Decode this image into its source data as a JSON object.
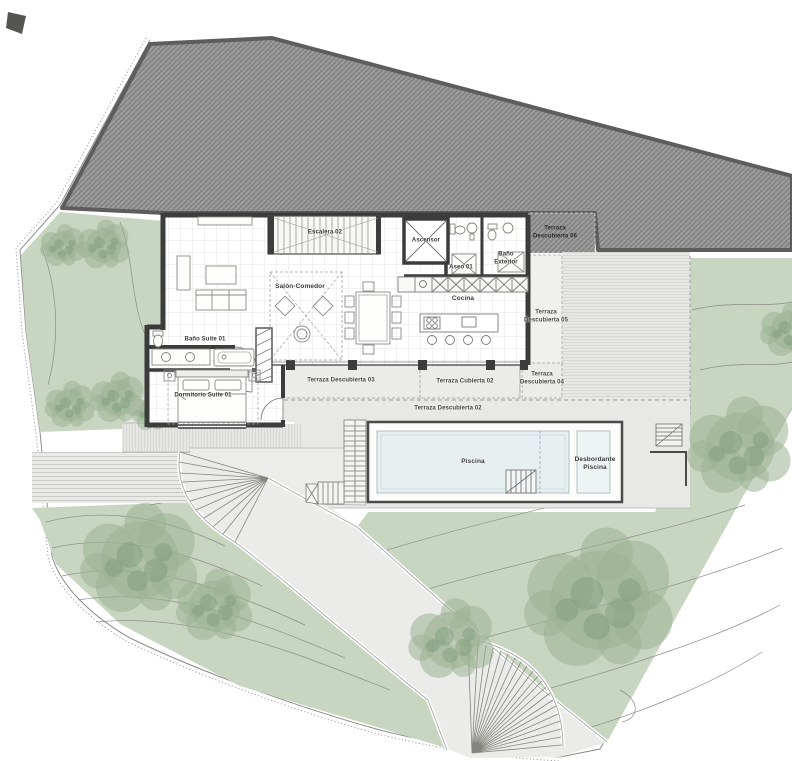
{
  "plan": {
    "labels": {
      "escalera": "Escalera 02",
      "salon_comedor": "Salón-Comedor",
      "ascensor": "Ascensor",
      "aseo": "Aseo 01",
      "bano_exterior": "Baño Exterior",
      "cocina": "Cocina",
      "bano_suite": "Baño Suite 01",
      "dormitorio_suite": "Dormitorio Suite 01",
      "terraza_descubierta_02": "Terraza Descubierta 02",
      "terraza_descubierta_03": "Terraza Descubierta 03",
      "terraza_descubierta_04": "Terraza Descubierta 04",
      "terraza_descubierta_05": "Terraza Descubierta 05",
      "terraza_descubierta_06": "Terraza Descubierta 06",
      "terraza_cubierta_02": "Terraza Cubierta 02",
      "piscina": "Piscina",
      "desbordante_piscina": "Desbordante Piscina"
    },
    "colors": {
      "hillside_gray": "#888888",
      "hillside_border": "#5d5d5d",
      "wall_dark": "#3c3c3c",
      "terrace_gray": "#e8e8e6",
      "garden_green": "#c8d5c0",
      "tree_green": "#9bb394",
      "pool_water": "#e8eff1",
      "path_gray": "#ebebe9"
    }
  }
}
